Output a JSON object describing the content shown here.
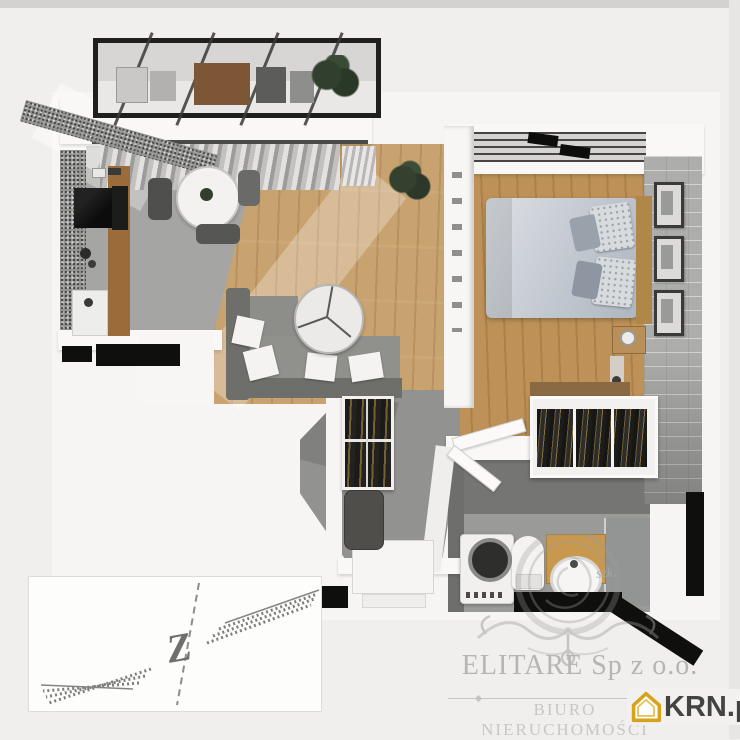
{
  "image": {
    "type": "3d-apartment-floor-plan-render",
    "width": 740,
    "height": 739
  },
  "watermarks": {
    "agency_name": "ELITARE Sp z o.o.",
    "agency_subtitle": "BIURO NIERUCHOMOŚCI",
    "script_fragment": "szk.",
    "portal_name": "KRN.pl",
    "portal_house_color": "#D8A31C",
    "portal_text_color": "#434341",
    "watermark_text_color": "#B5B5B3"
  },
  "compass": {
    "direction_label": "Z"
  },
  "rooms": [
    "balcony",
    "kitchen",
    "living-room",
    "bedroom",
    "hallway",
    "bathroom"
  ],
  "palette": {
    "background": "#F0EFED",
    "wall_white": "#F9F8F6",
    "wall_cut_black": "#0F0F0D",
    "wood_floor_living": "#C8A26F",
    "wood_floor_bedroom": "#BD9157",
    "kitchen_floor_gray": "#A5A5A3",
    "hall_floor_gray": "#929290",
    "granite_counter": "#969795",
    "sofa_gray": "#8D8D89",
    "bedding_gray_blue": "#C2C8D0",
    "brick_accent_wall": "#ADADAB",
    "plant_green": "#31402E",
    "vanity_wood": "#C8984E"
  }
}
